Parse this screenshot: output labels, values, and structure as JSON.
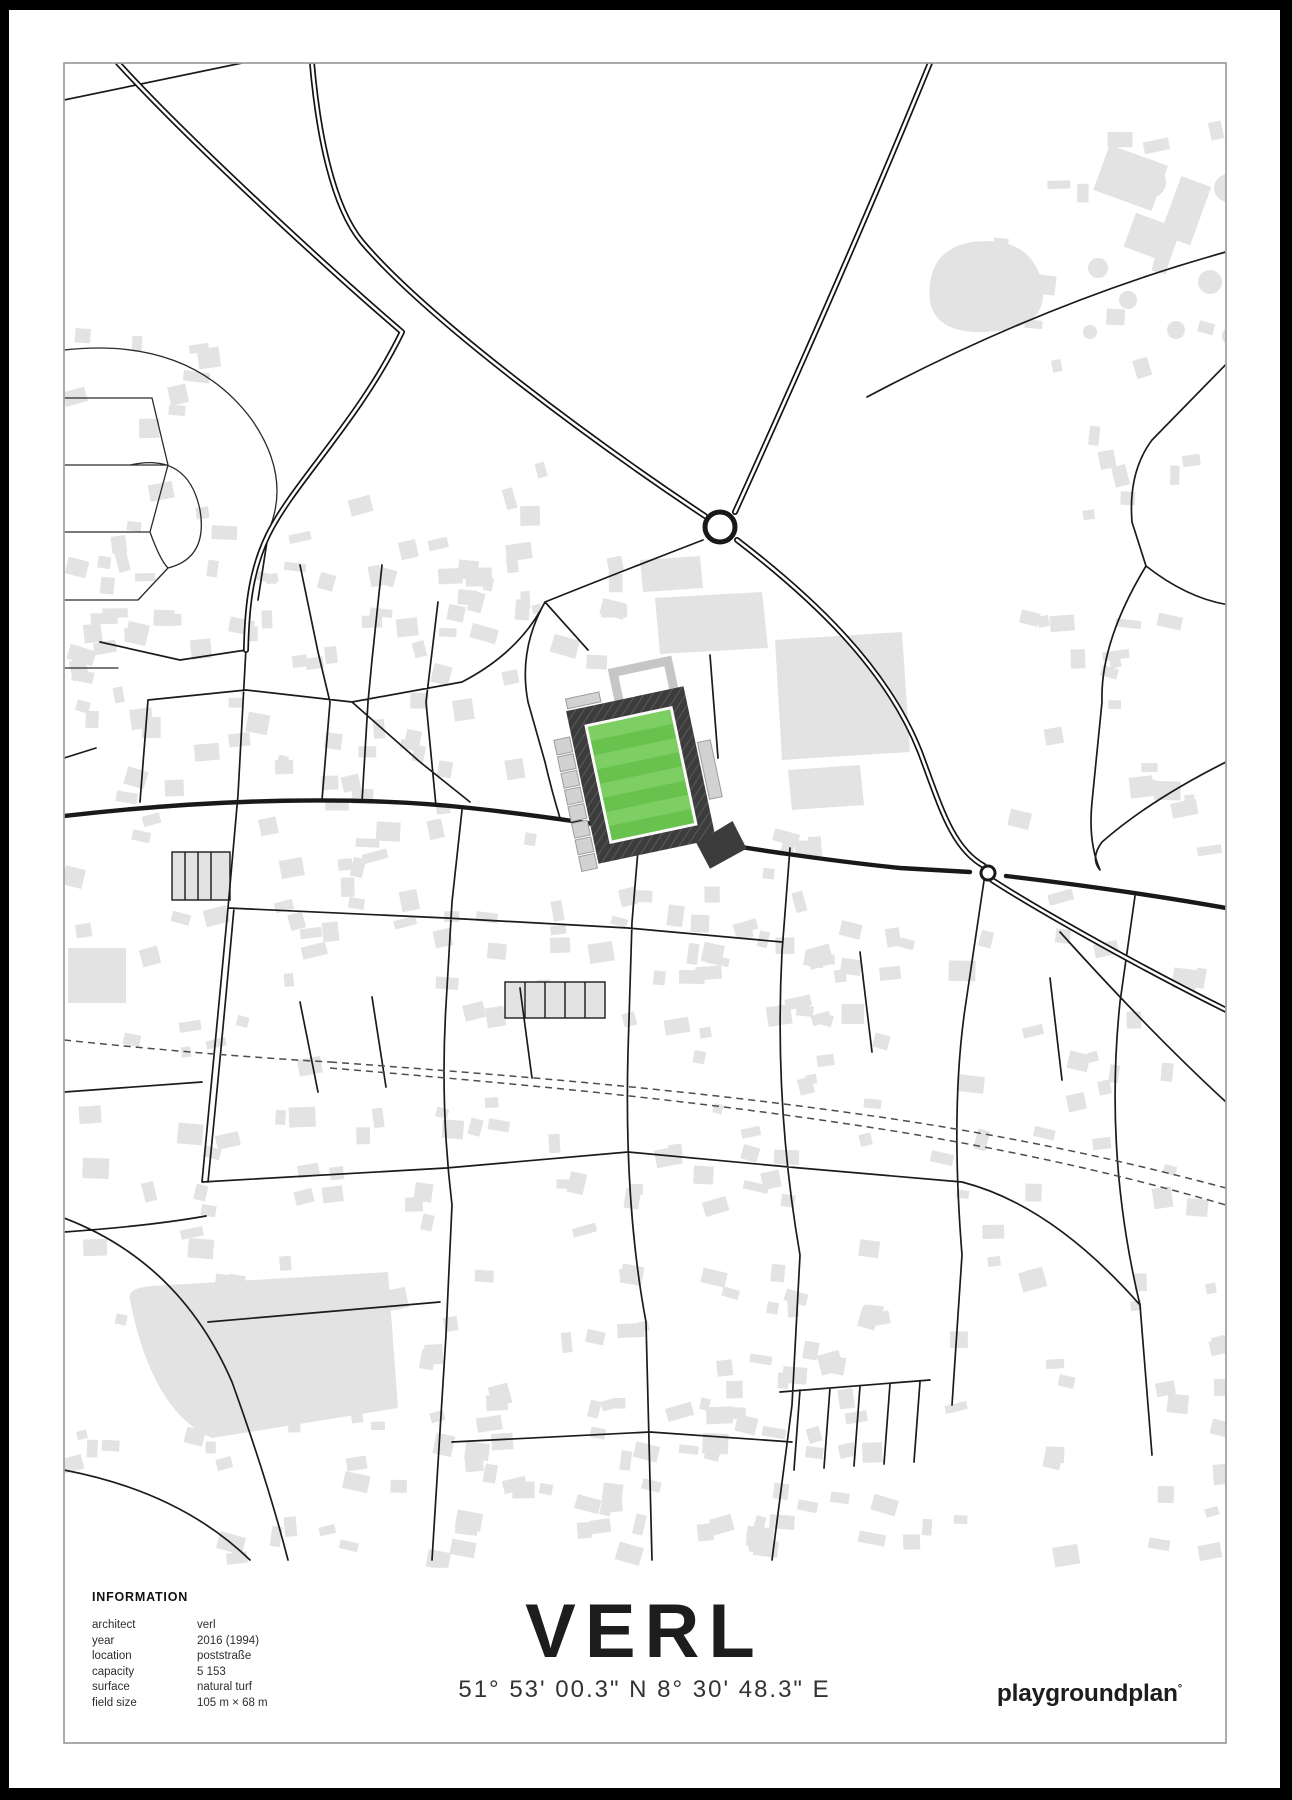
{
  "poster": {
    "title": "VERL",
    "coordinates": "51° 53' 00.3\" N 8° 30' 48.3\" E",
    "brand": "playgroundplan",
    "brand_mark": "°",
    "info": {
      "heading": "INFORMATION",
      "rows": [
        {
          "label": "architect",
          "value": "verl"
        },
        {
          "label": "year",
          "value": "2016 (1994)"
        },
        {
          "label": "location",
          "value": "poststraße"
        },
        {
          "label": "capacity",
          "value": "5 153"
        },
        {
          "label": "surface",
          "value": "natural turf"
        },
        {
          "label": "field size",
          "value": "105 m × 68 m"
        }
      ]
    }
  },
  "colors": {
    "pitch_green": "#69c24d",
    "pitch_stripe": "#7dce63",
    "stand_dark": "#3c3c3c",
    "building_gray": "#e3e3e3",
    "road_black": "#1b1b1b",
    "railway_gray": "#4d4d4d",
    "frame_black": "#000000"
  }
}
